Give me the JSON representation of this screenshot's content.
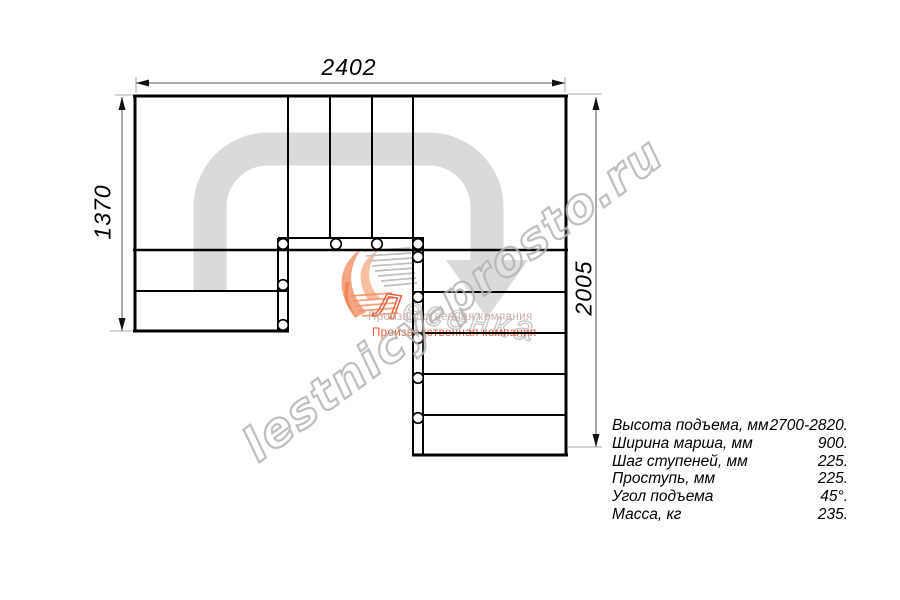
{
  "drawing": {
    "dim_top": "2402",
    "dim_left": "1370",
    "dim_right": "2005"
  },
  "specs": {
    "rows": [
      {
        "label": "Высота подъема, мм",
        "value": "2700-2820."
      },
      {
        "label": "Ширина марша, мм",
        "value": "900."
      },
      {
        "label": "Шаг ступеней, мм",
        "value": "225."
      },
      {
        "label": "Проступь, мм",
        "value": "225."
      },
      {
        "label": "Угол подъема",
        "value": "45°."
      },
      {
        "label": "Масса, кг",
        "value": "235."
      }
    ]
  },
  "watermark": {
    "text": "lestnicy-prosto.ru"
  },
  "logo": {
    "name": "Лесенка",
    "name_initial": "Л",
    "tagline_gray": "Производственная компания",
    "tagline_orange": "Производственная компания"
  },
  "colors": {
    "line": "#000000",
    "walk_path": "#dadada",
    "watermark_gray": "#b4b4b4",
    "logo_orange": "#e8532a",
    "logo_salmon": "#f19066",
    "dimension": "#555555"
  }
}
